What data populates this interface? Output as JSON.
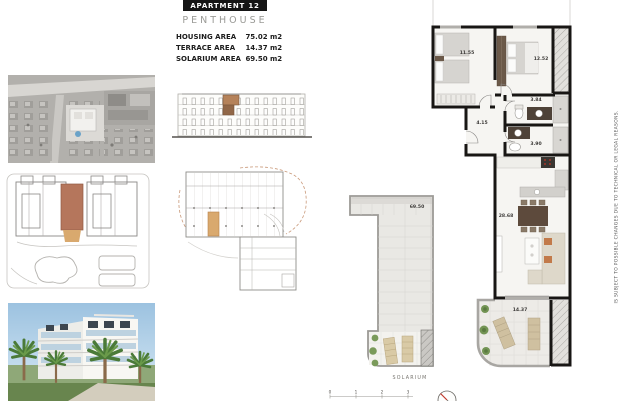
{
  "header": {
    "title": "APARTMENT 12",
    "subtitle": "PENTHOUSE",
    "areas": [
      {
        "label": "HOUSING AREA",
        "value": "75.02 m2"
      },
      {
        "label": "TERRACE AREA",
        "value": "14.37 m2"
      },
      {
        "label": "SOLARIUM AREA",
        "value": "69.50 m2"
      }
    ]
  },
  "main_plan": {
    "bedroom1": "11.55",
    "bedroom2": "12.52",
    "bathroom1": "3.84",
    "hall": "4.15",
    "bathroom2": "3.90",
    "living": "28.68",
    "terrace": "14.37"
  },
  "solarium": {
    "area": "69.50",
    "caption": "SOLARIUM"
  },
  "scale": {
    "ticks": [
      "0",
      "1",
      "2",
      "3"
    ]
  },
  "disclaimer": "IS SUBJECT TO POSSIBLE CHANGES DUE TO TECHNICAL OR LEGAL REASONS.",
  "colors": {
    "highlight_brown": "#b5765c",
    "highlight_tan": "#d9a96e",
    "wall_black": "#181614",
    "compass_red": "#c23a2e"
  }
}
